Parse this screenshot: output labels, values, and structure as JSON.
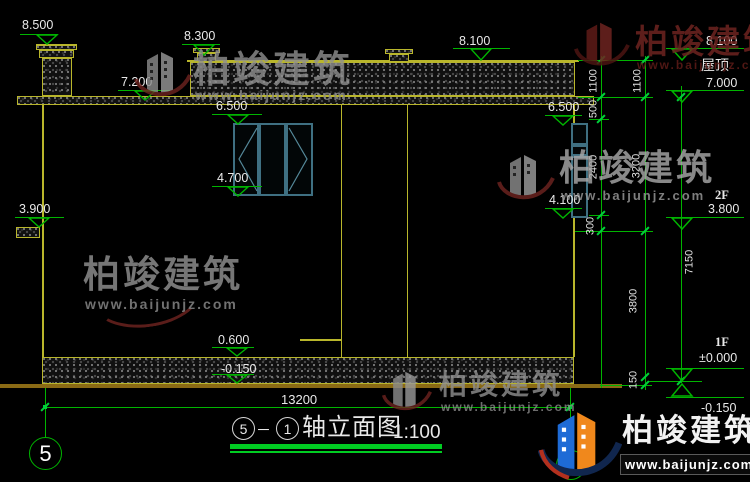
{
  "drawing_title": {
    "axis_from": "5",
    "sep": "－",
    "axis_to": "1",
    "name": "轴立面图",
    "scale": "1:100"
  },
  "axis_bubble_left": "5",
  "overall_width_dim": "13200",
  "levels": {
    "chimney_top": "8.500",
    "vent_top": "8.300",
    "roof_band_top": "8.100",
    "parapet_left": "7.200",
    "win_mid_top": "6.500",
    "win_mid_bottom": "4.700",
    "canopy_left": "3.900",
    "win_right_top": "6.500",
    "win_right_bottom": "4.100",
    "plinth_top": "0.600",
    "ground_center": "-0.150",
    "right_8100": "8.100",
    "right_roof_label": "屋顶",
    "right_7000": "7.000",
    "right_2f_label": "2F",
    "right_3800": "3.800",
    "right_1f_label": "1F",
    "right_zero": "±0.000",
    "right_neg150": "-0.150"
  },
  "dims": {
    "a1": "1100",
    "a2": "500",
    "a3": "2400",
    "a4": "300",
    "b1": "1100",
    "b2": "3200",
    "b3": "3800",
    "b4": "150",
    "overall": "7150"
  },
  "brand": {
    "name": "柏竣建筑",
    "url": "www.baijunjz.com"
  }
}
